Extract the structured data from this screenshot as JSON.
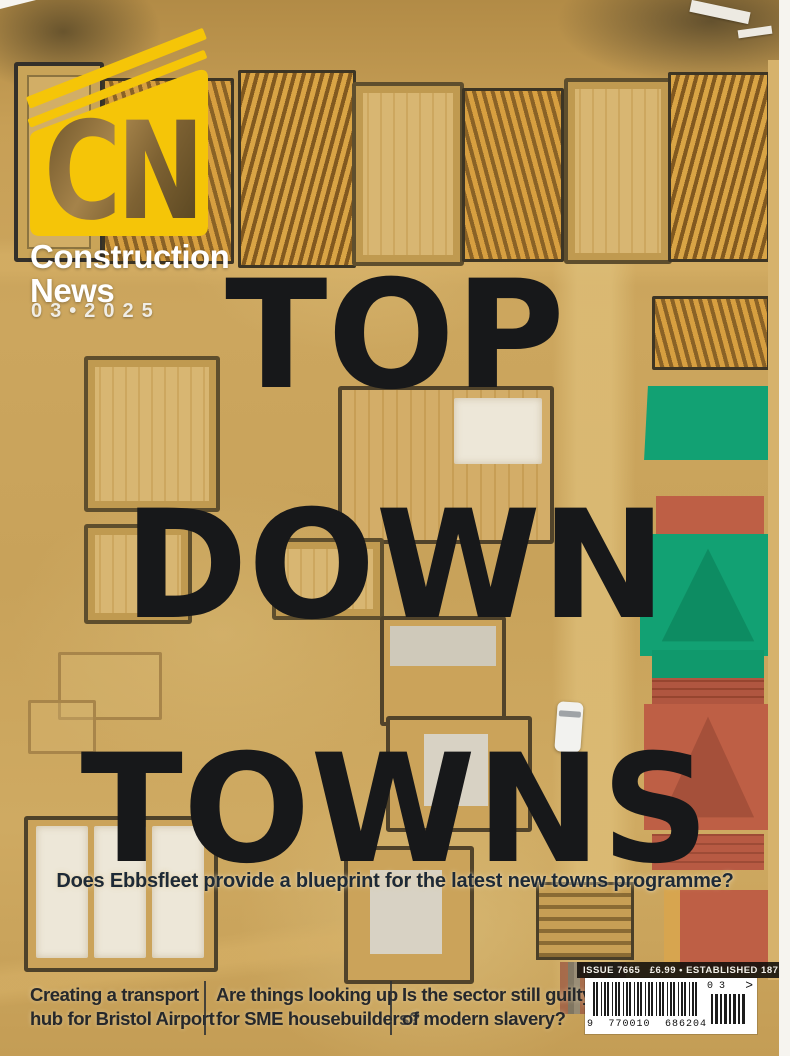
{
  "cover": {
    "masthead": {
      "logo_letters": "CN",
      "name_line1": "Construction",
      "name_line2": "News",
      "issue_date": "03•2025"
    },
    "headline": {
      "line1": "TOP",
      "line2": "DOWN",
      "line3": "TOWNS"
    },
    "subheadline": "Does Ebbsfleet provide a blueprint for the latest new towns programme?",
    "teasers": [
      {
        "line1": "Creating a transport",
        "line2": "hub for Bristol Airport"
      },
      {
        "line1": "Are things looking up",
        "line2": "for SME housebuilders?"
      },
      {
        "line1": "Is the sector still guilty",
        "line2": "of modern slavery?"
      }
    ],
    "issue_strip": "ISSUE 7665   £6.99 • ESTABLISHED 1871",
    "barcode": {
      "digits_left": "9",
      "digits_group1": "770010",
      "digits_group2": "686204",
      "addon_digits": "0 3",
      "addon_arrow": ">"
    }
  },
  "colors": {
    "brand_yellow": "#F5C508",
    "headline_black": "#17181A",
    "subheadline_navy": "#1E2A36",
    "teaser_text": "#26282B",
    "sand_base": "#C8A35D",
    "roof_green": "#12A173",
    "roof_red": "#BE5F45",
    "timber_orange": "#D2973C",
    "white": "#FFFFFF"
  }
}
